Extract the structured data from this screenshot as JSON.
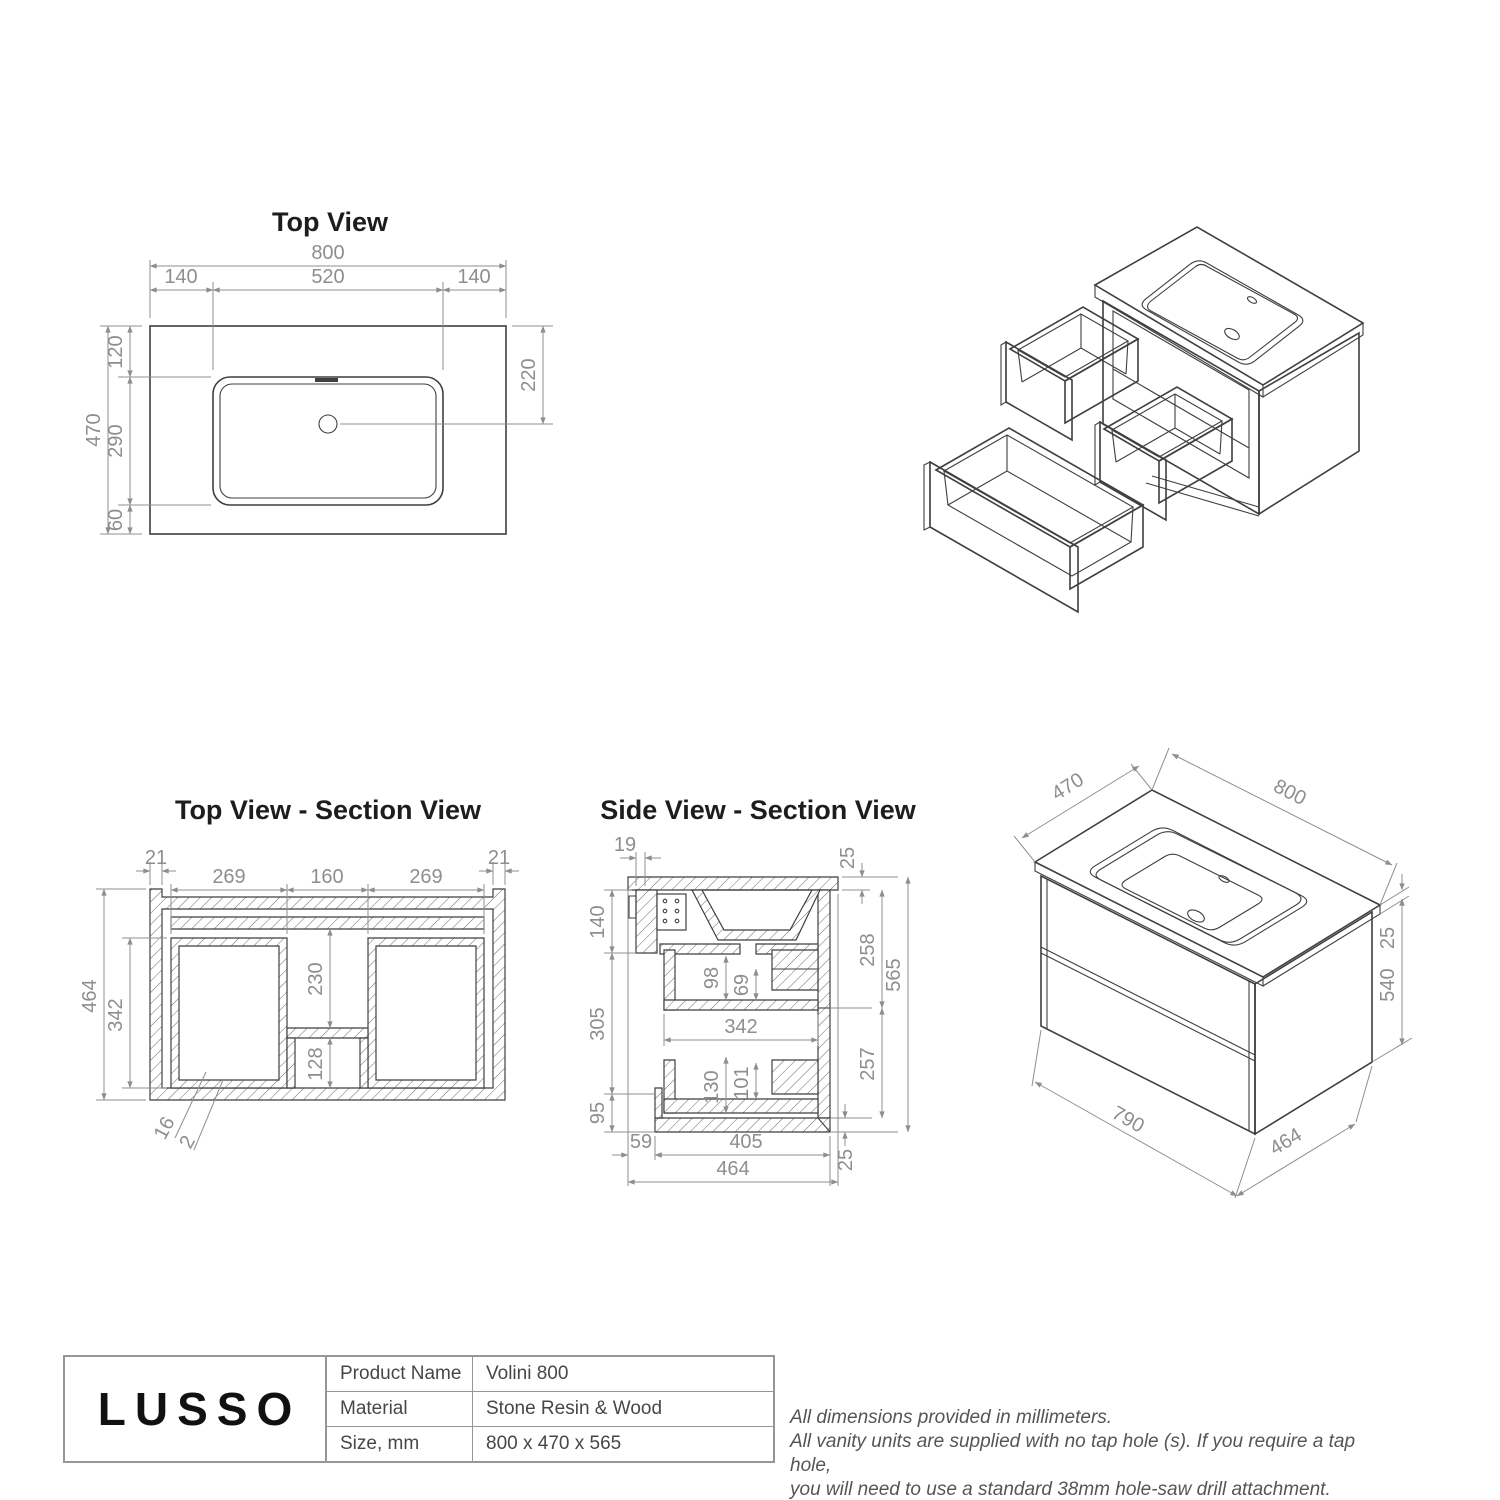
{
  "titles": {
    "top_view": "Top View",
    "top_section": "Top View - Section View",
    "side_section": "Side View - Section View"
  },
  "top_view": {
    "width": "800",
    "margin_left": "140",
    "basin_width": "520",
    "margin_right": "140",
    "depth": "470",
    "front_offset": "120",
    "basin_depth": "290",
    "back_offset": "60",
    "waste_offset": "220"
  },
  "top_section": {
    "wall_left": "21",
    "bay_left": "269",
    "channel": "160",
    "bay_right": "269",
    "wall_right": "21",
    "depth": "464",
    "inner_depth": "342",
    "channel_depth": "230",
    "pocket": "128",
    "leader_thickness": "16",
    "leader_gap": "2"
  },
  "side_section": {
    "rail": "19",
    "top_thickness": "25",
    "upper": "140",
    "drawer1_depth": "98",
    "drawer1_inner": "69",
    "front_upper": "258",
    "height": "565",
    "middle": "305",
    "inner_width": "342",
    "lower": "95",
    "drawer2_depth": "130",
    "drawer2_inner": "101",
    "front_lower": "257",
    "back_gap": "59",
    "base_width": "405",
    "base_depth": "464",
    "base_thickness": "25"
  },
  "iso": {
    "depth": "470",
    "width": "800",
    "top_thickness": "25",
    "body_height": "540",
    "front_width": "790",
    "side_depth": "464"
  },
  "title_block": {
    "logo": "LUSSO",
    "rows": [
      {
        "label": "Product Name",
        "value": "Volini 800"
      },
      {
        "label": "Material",
        "value": "Stone Resin & Wood"
      },
      {
        "label": "Size, mm",
        "value": "800 x 470 x 565"
      }
    ]
  },
  "notes": {
    "line1": "All dimensions provided in millimeters.",
    "line2": "All vanity units are supplied with no tap hole (s). If you require a tap hole,",
    "line3": "you will need to use a standard 38mm hole-saw drill attachment."
  }
}
